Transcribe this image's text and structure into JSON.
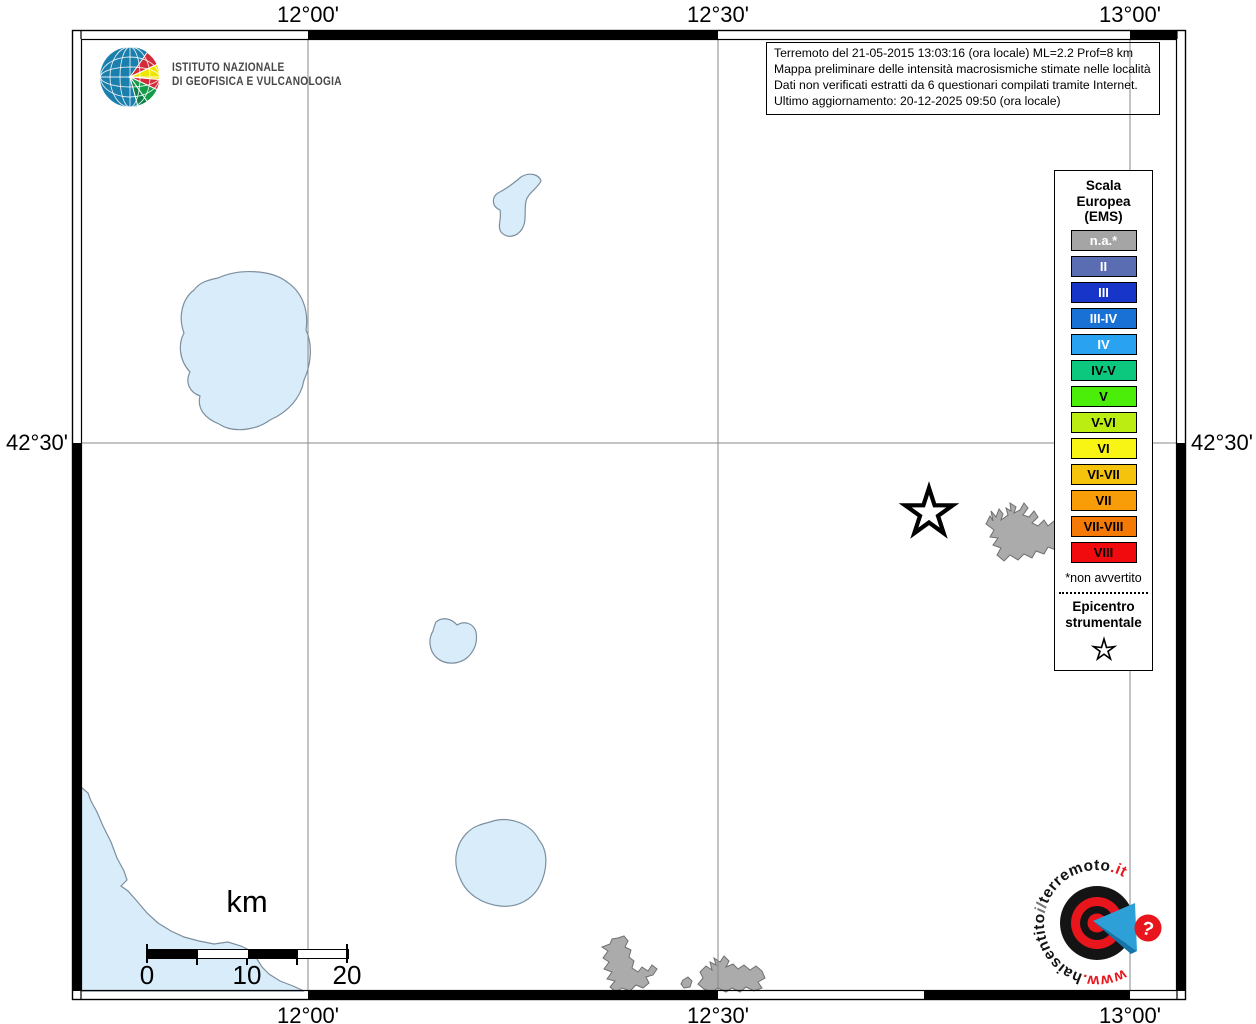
{
  "info_box": {
    "lines": [
      "Terremoto del 21-05-2015 13:03:16 (ora locale) ML=2.2 Prof=8 km",
      "Mappa preliminare delle intensità macrosismiche stimate nelle località",
      "Dati non verificati estratti da 6 questionari compilati tramite Internet.",
      "Ultimo aggiornamento: 20-12-2025 09:50 (ora locale)"
    ]
  },
  "coordinates": {
    "top": [
      "12°00'",
      "12°30'",
      "13°00'"
    ],
    "bottom": [
      "12°00'",
      "12°30'",
      "13°00'"
    ],
    "left": "42°30'",
    "right": "42°30'"
  },
  "legend": {
    "title_lines": [
      "Scala",
      "Europea",
      "(EMS)"
    ],
    "items": [
      {
        "label": "n.a.*",
        "color": "#a5a5a5",
        "text_color": "#ffffff"
      },
      {
        "label": "II",
        "color": "#5a6cb2",
        "text_color": "#ffffff"
      },
      {
        "label": "III",
        "color": "#1736c9",
        "text_color": "#ffffff"
      },
      {
        "label": "III-IV",
        "color": "#1971d6",
        "text_color": "#ffffff"
      },
      {
        "label": "IV",
        "color": "#29a3f1",
        "text_color": "#ffffff"
      },
      {
        "label": "IV-V",
        "color": "#0cc77e",
        "text_color": "#000000"
      },
      {
        "label": "V",
        "color": "#4aee09",
        "text_color": "#000000"
      },
      {
        "label": "V-VI",
        "color": "#bced12",
        "text_color": "#000000"
      },
      {
        "label": "VI",
        "color": "#f8f414",
        "text_color": "#000000"
      },
      {
        "label": "VI-VII",
        "color": "#f5c30b",
        "text_color": "#000000"
      },
      {
        "label": "VII",
        "color": "#f89d07",
        "text_color": "#000000"
      },
      {
        "label": "VII-VIII",
        "color": "#f47a05",
        "text_color": "#000000"
      },
      {
        "label": "VIII",
        "color": "#f10a0e",
        "text_color": "#000000"
      }
    ],
    "footnote": "*non avvertito",
    "epicenter_lines": [
      "Epicentro",
      "strumentale"
    ]
  },
  "scale_bar": {
    "unit_label": "km",
    "tick_labels": [
      "0",
      "10",
      "20"
    ]
  },
  "ingv_logo": {
    "lines": [
      "ISTITUTO NAZIONALE",
      "DI GEOFISICA E VULCANOLOGIA"
    ]
  },
  "hsit_logo": {
    "segments": {
      "www": "www.",
      "hai": "haisentito",
      "il": "il",
      "terremoto": "terremoto",
      "it": ".it",
      "question": "?"
    },
    "colors": {
      "red": "#e8151c",
      "black": "#141414",
      "blue": "#2da0d8"
    }
  },
  "map_colors": {
    "water": "#d9ecfa",
    "water_outline": "#7d8f9e",
    "urban": "#ababab",
    "urban_outline": "#6f6f6f",
    "gridline": "#8a8a8a"
  }
}
